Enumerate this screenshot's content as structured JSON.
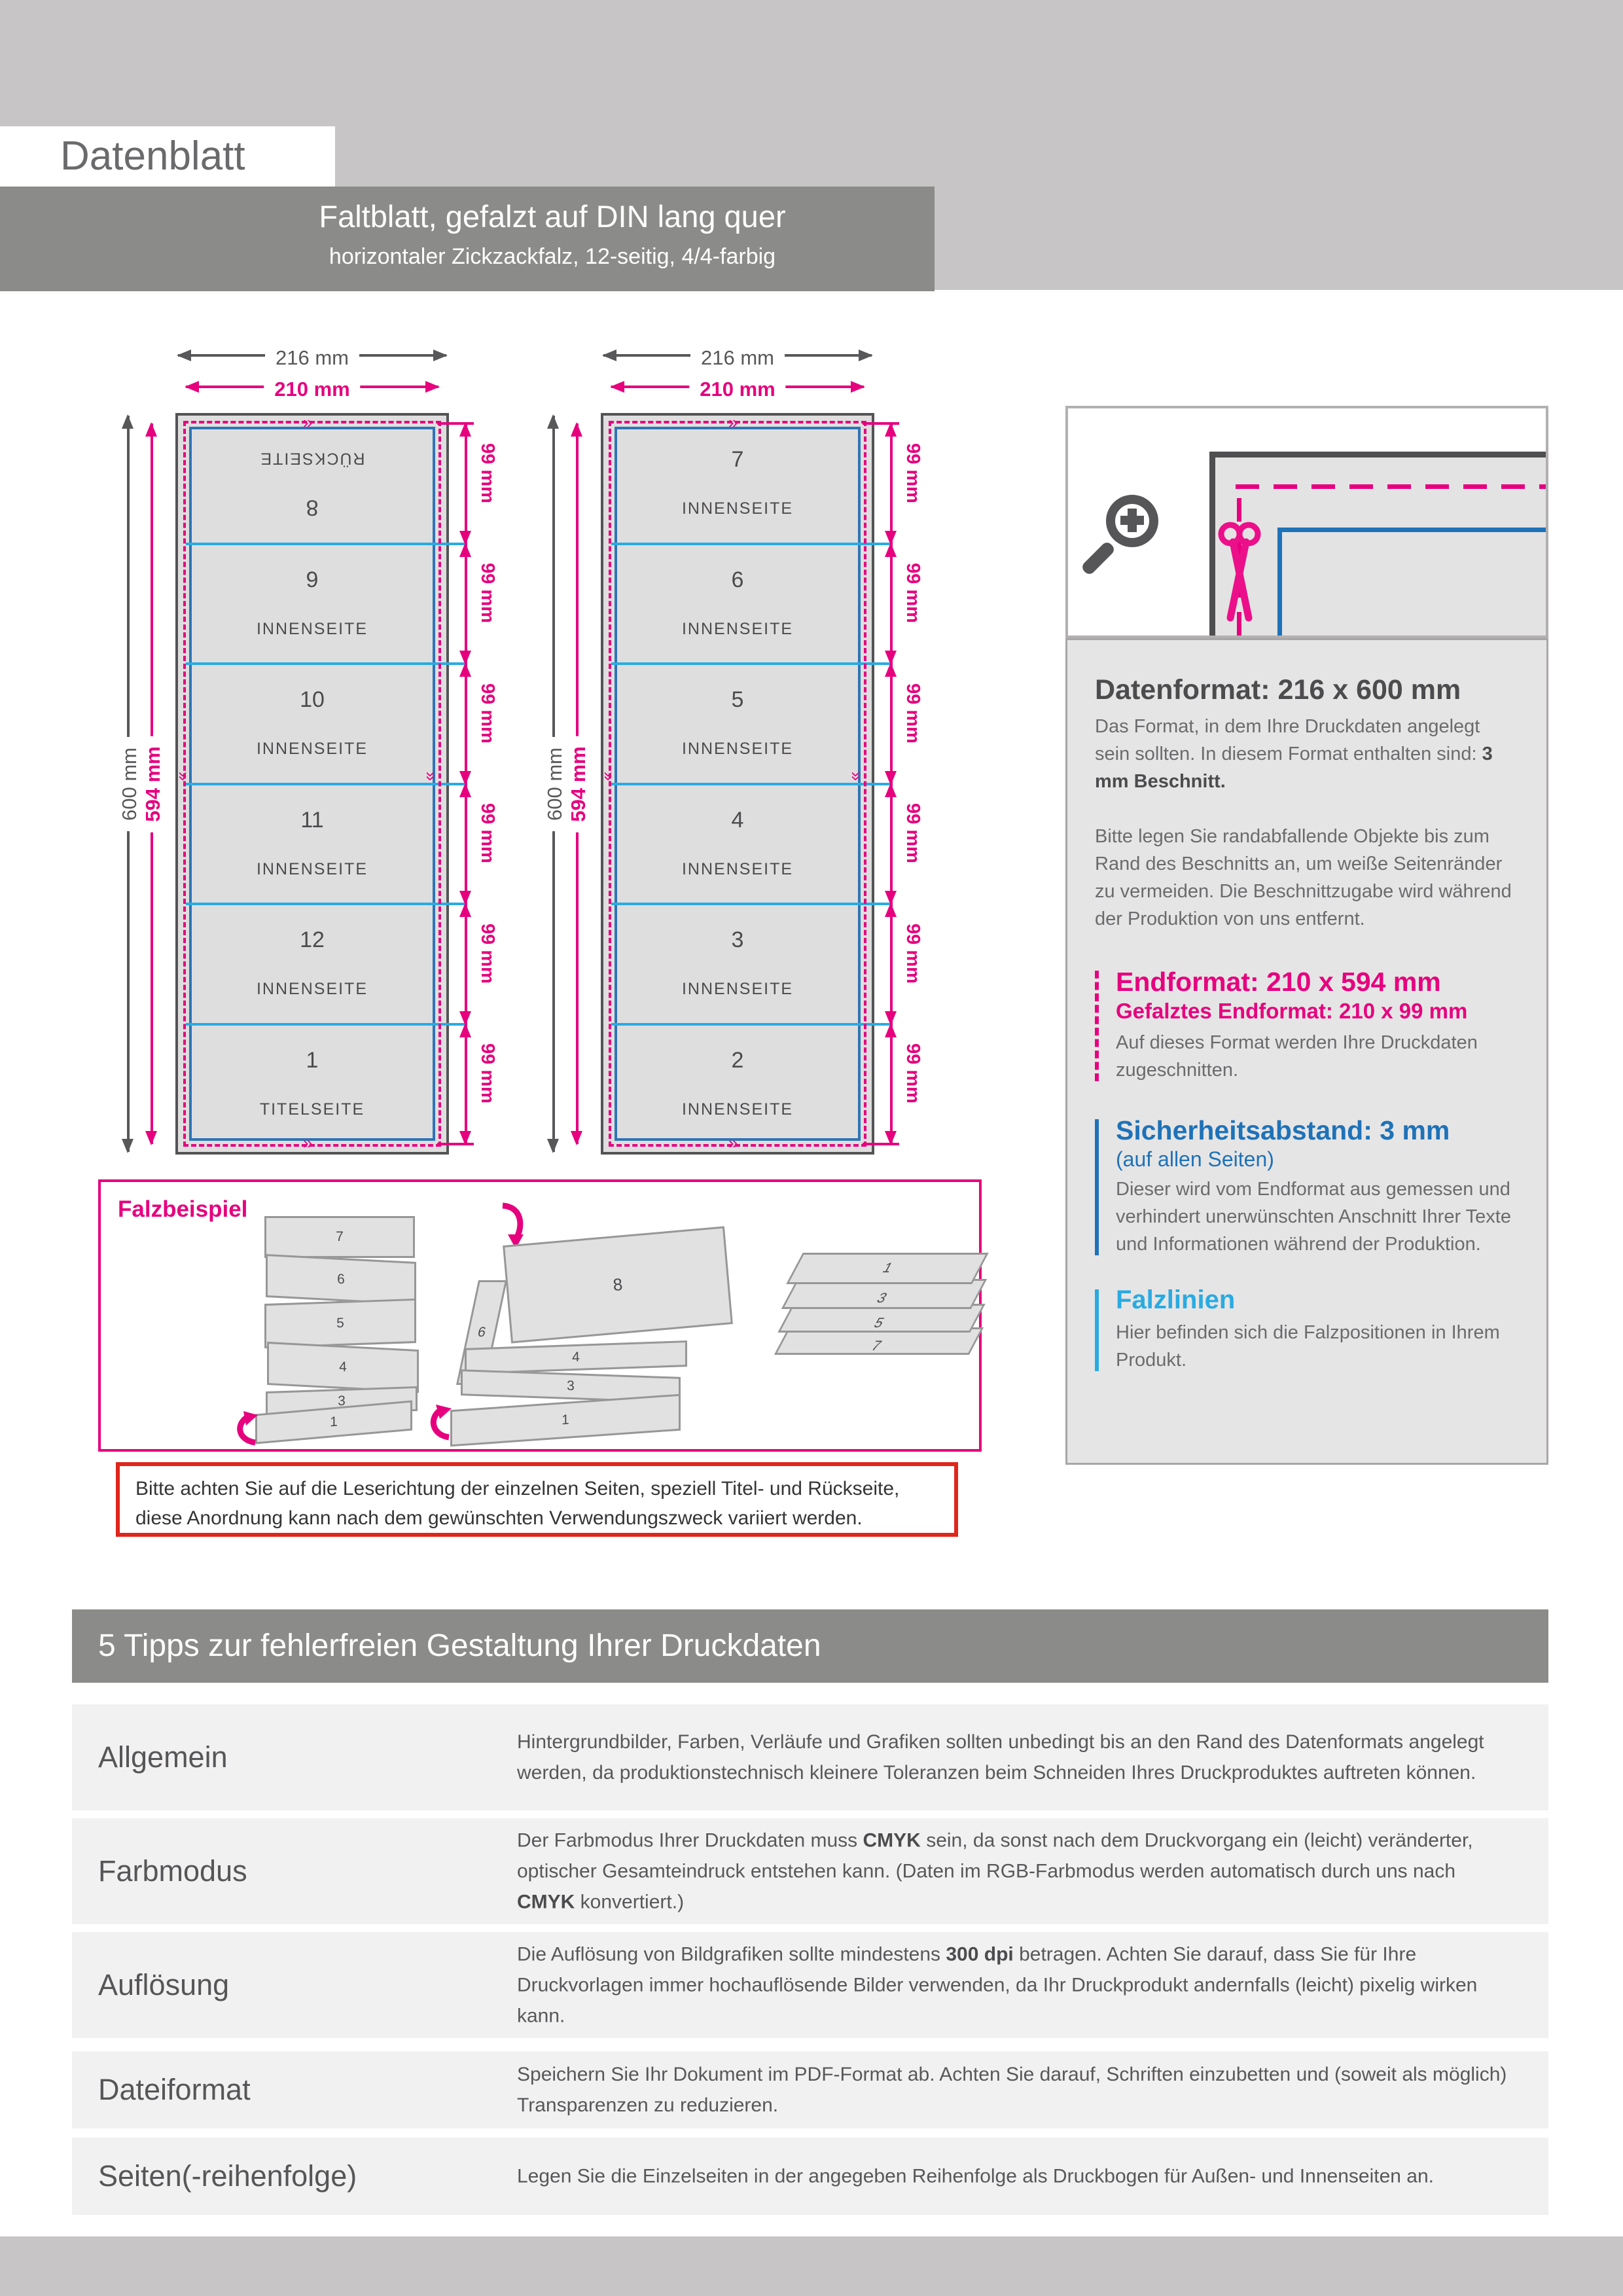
{
  "header": {
    "page_label": "Datenblatt",
    "title": "Faltblatt, gefalzt auf DIN lang quer",
    "subtitle": "horizontaler Zickzackfalz, 12-seitig, 4/4-farbig"
  },
  "colors": {
    "magenta": "#e6007e",
    "cyan_foldline": "#29abe2",
    "blue_safety": "#1e72b8",
    "dark_gray": "#58585a",
    "band_gray": "#8b8b89",
    "light_gray": "#c7c5c6",
    "red_note": "#e0251b"
  },
  "icons": {
    "magnifier": "zoom-in-icon",
    "scissors": "scissors-icon",
    "fold_arrows": "fold-direction-arrow-icon"
  },
  "diagrams": [
    {
      "id": "outside",
      "width_label": "216 mm",
      "trim_width_label": "210 mm",
      "height_label": "600 mm",
      "trim_height_label": "594 mm",
      "segment_label": "99 mm",
      "panels": [
        {
          "number": "8",
          "label": "RÜCKSEITE",
          "rotated": true
        },
        {
          "number": "9",
          "label": "INNENSEITE",
          "rotated": false
        },
        {
          "number": "10",
          "label": "INNENSEITE",
          "rotated": false
        },
        {
          "number": "11",
          "label": "INNENSEITE",
          "rotated": false
        },
        {
          "number": "12",
          "label": "INNENSEITE",
          "rotated": false
        },
        {
          "number": "1",
          "label": "TITELSEITE",
          "rotated": false
        }
      ]
    },
    {
      "id": "inside",
      "width_label": "216 mm",
      "trim_width_label": "210 mm",
      "height_label": "600 mm",
      "trim_height_label": "594 mm",
      "segment_label": "99 mm",
      "panels": [
        {
          "number": "7",
          "label": "INNENSEITE",
          "rotated": false
        },
        {
          "number": "6",
          "label": "INNENSEITE",
          "rotated": false
        },
        {
          "number": "5",
          "label": "INNENSEITE",
          "rotated": false
        },
        {
          "number": "4",
          "label": "INNENSEITE",
          "rotated": false
        },
        {
          "number": "3",
          "label": "INNENSEITE",
          "rotated": false
        },
        {
          "number": "2",
          "label": "INNENSEITE",
          "rotated": false
        }
      ]
    }
  ],
  "fold_example": {
    "title": "Falzbeispiel",
    "strip_panels": [
      "7",
      "6",
      "5",
      "4",
      "3",
      "1"
    ],
    "half_folded_labels": [
      "8",
      "6",
      "4",
      "3",
      "1"
    ],
    "stack_labels": [
      "1",
      "3",
      "5",
      "7"
    ]
  },
  "note": {
    "text": "Bitte achten Sie auf die Leserichtung der einzelnen Seiten, speziell Titel- und Rückseite, diese Anordnung kann nach dem gewünschten Verwendungszweck variiert werden."
  },
  "info": {
    "datenformat": {
      "heading": "Datenformat: 216 x 600 mm",
      "p1": [
        {
          "t": "Das Format, in dem Ihre Druckdaten angelegt sein sollten. In diesem Format enthalten sind: "
        },
        {
          "t": "3 mm Beschnitt.",
          "b": true
        }
      ],
      "p2": [
        {
          "t": "Bitte legen Sie randabfallende Objekte bis zum Rand des Beschnitts an, um weiße Seitenränder zu vermeiden. Die Beschnittzugabe wird während der Produktion von uns entfernt."
        }
      ]
    },
    "endformat": {
      "heading": "Endformat: 210 x 594 mm",
      "subheading": "Gefalztes Endformat: 210 x 99 mm",
      "text": "Auf dieses Format werden Ihre Druckdaten zugeschnitten."
    },
    "sicherheitsabstand": {
      "heading": "Sicherheitsabstand: 3 mm",
      "subheading": "(auf allen Seiten)",
      "text": "Dieser wird vom Endformat aus gemessen und verhindert unerwünschten Anschnitt Ihrer Texte und Informationen während der Produktion."
    },
    "falzlinien": {
      "heading": "Falzlinien",
      "text": "Hier befinden sich die Falzpositionen in Ihrem Produkt."
    }
  },
  "tips": {
    "heading": "5 Tipps zur fehlerfreien Gestaltung Ihrer Druckdaten",
    "rows": [
      {
        "label": "Allgemein",
        "segments": [
          {
            "t": "Hintergrundbilder, Farben, Verläufe und Grafiken sollten unbedingt bis an den Rand des Datenformats angelegt werden, da produktionstechnisch kleinere Toleranzen beim Schneiden Ihres Druckproduktes auftreten können."
          }
        ]
      },
      {
        "label": "Farbmodus",
        "segments": [
          {
            "t": "Der Farbmodus Ihrer Druckdaten muss "
          },
          {
            "t": "CMYK",
            "b": true
          },
          {
            "t": " sein, da sonst nach dem Druckvorgang ein (leicht) veränderter, optischer Gesamteindruck entstehen kann. (Daten im RGB-Farbmodus werden automatisch durch uns nach "
          },
          {
            "t": "CMYK",
            "b": true
          },
          {
            "t": " konvertiert.)"
          }
        ]
      },
      {
        "label": "Auflösung",
        "segments": [
          {
            "t": "Die Auflösung von Bildgrafiken sollte mindestens "
          },
          {
            "t": "300 dpi",
            "b": true
          },
          {
            "t": " betragen. Achten Sie darauf, dass Sie für Ihre Druckvorlagen immer hochauflösende Bilder verwenden, da Ihr Druckprodukt andernfalls (leicht) pixelig wirken kann."
          }
        ]
      },
      {
        "label": "Dateiformat",
        "segments": [
          {
            "t": "Speichern Sie Ihr Dokument im PDF-Format ab. Achten Sie darauf, Schriften einzubetten und (soweit als möglich) Transparenzen zu reduzieren."
          }
        ]
      },
      {
        "label": "Seiten(-reihenfolge)",
        "segments": [
          {
            "t": "Legen Sie die Einzelseiten in der angegeben Reihenfolge als Druckbogen für Außen- und Innenseiten an."
          }
        ]
      }
    ]
  }
}
